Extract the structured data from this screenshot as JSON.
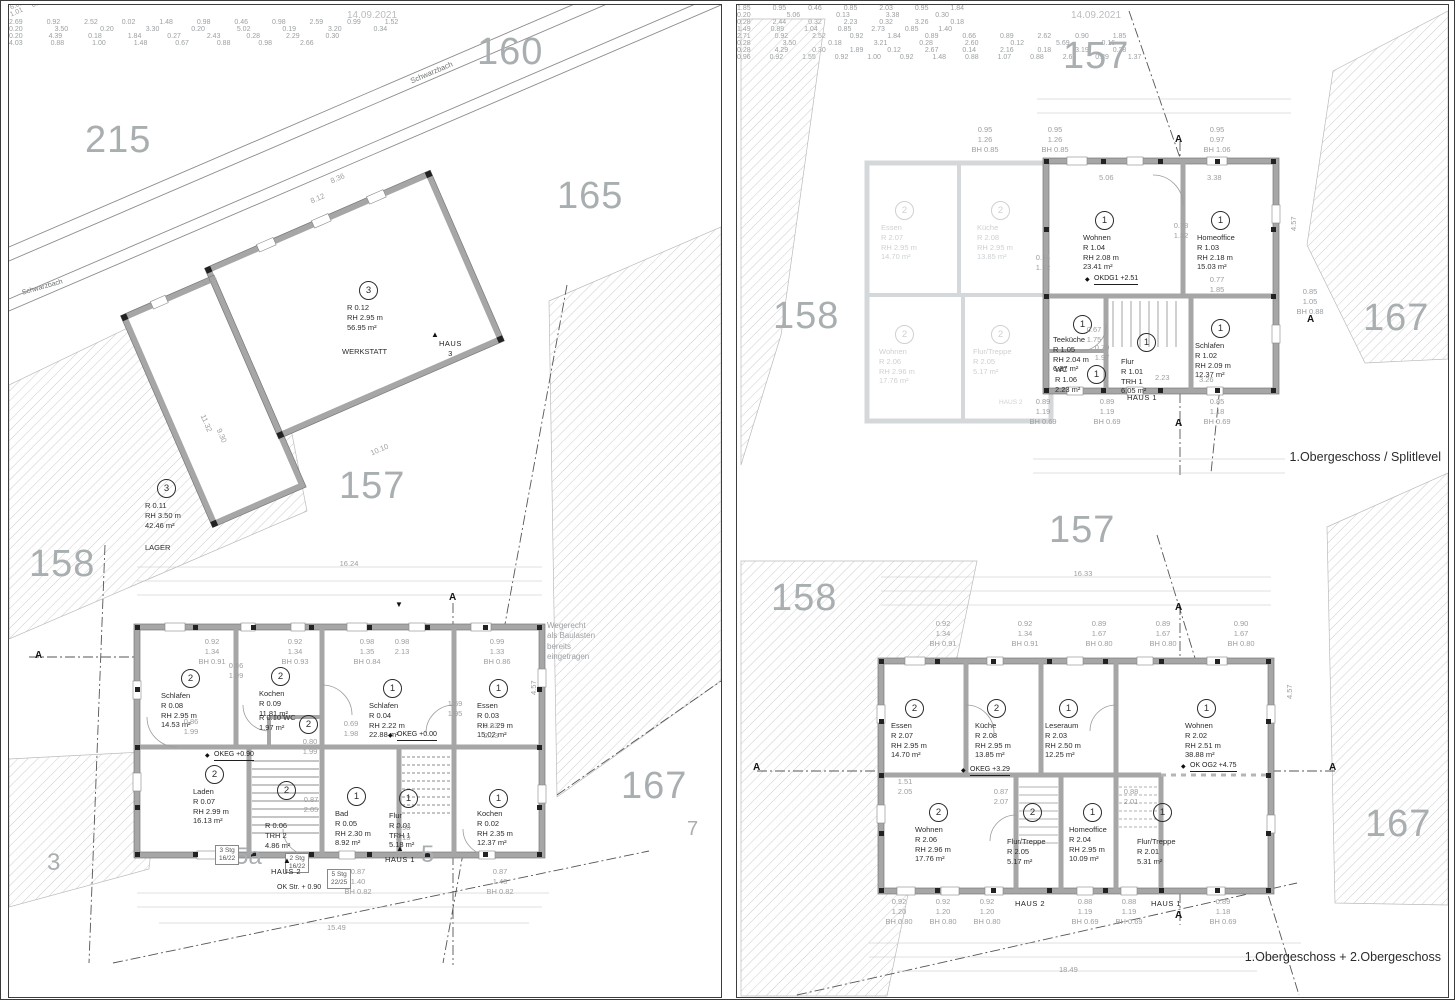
{
  "icons": {
    "level": "◆",
    "tri": "▲",
    "tri_down": "▼"
  },
  "left": {
    "date": "14.09.2021",
    "parcels": {
      "p160": "160",
      "p215": "215",
      "p165": "165",
      "p157": "157",
      "p158": "158",
      "p167": "167",
      "p3": "3",
      "p7": "7",
      "p5a": "5a",
      "p5": "5"
    },
    "streets": {
      "top": "Schwarzbach",
      "left": "Schwarzbach"
    },
    "note": "Wegerecht\nals Baulasten\nbereits\neingetragen",
    "haus_labels": {
      "h1": "HAUS 1",
      "h2": "HAUS 2",
      "h3": "HAUS\n3"
    },
    "levels": {
      "eg": "OKEG +0.00",
      "eg90": "OKEG +0.90",
      "street": "OK Str. + 0.90"
    },
    "stairs": {
      "s1": "3 Stg\n16/22",
      "s2": "2 Stg\n16/22",
      "s3": "5 Stg\n22/25"
    },
    "rooms": [
      {
        "unit": "3",
        "lines": "R 0.12\nRH 2.95 m\n56.95 m²",
        "name": "WERKSTATT"
      },
      {
        "unit": "3",
        "lines": "R 0.11\nRH 3.50 m\n42.46 m²",
        "name": "LAGER"
      },
      {
        "unit": "2",
        "lines": "Schlafen\nR 0.08\nRH 2.95 m\n14.53 m²"
      },
      {
        "unit": "2",
        "lines": "Kochen\nR 0.09\n11.81 m²"
      },
      {
        "unit": "2",
        "lines": "R 0.10 WC\n1.97 m²"
      },
      {
        "unit": "1",
        "lines": "Schlafen\nR 0.04\nRH 2.22 m\n22.88 m²"
      },
      {
        "unit": "1",
        "lines": "Essen\nR 0.03\nRH 2.29 m\n15.02 m²"
      },
      {
        "unit": "2",
        "lines": "Laden\nR 0.07\nRH 2.99 m\n16.13 m²"
      },
      {
        "unit": "2",
        "lines": "R 0.06\nTRH 2\n4.86 m²"
      },
      {
        "unit": "1",
        "lines": "Bad\nR 0.05\nRH 2.30 m\n8.92 m²"
      },
      {
        "unit": "1",
        "lines": "Flur\nR 0.01\nTRH 1\n5.18 m²"
      },
      {
        "unit": "1",
        "lines": "Kochen\nR 0.02\nRH 2.35 m\n12.37 m²"
      }
    ],
    "dims": {
      "total_top": "16.24",
      "row1": "2.69 0.92 2.52 0.02 1.48 0.98 0.46 0.98 2.59 0.99 1.52",
      "row2": "0.20 3.50 0.20 3.30 0.20 5.02 0.19 3.20 0.34",
      "brow1": "0.20 4.39 0.18 1.84 0.27 2.43 0.28 2.29 0.30",
      "brow2": "4.03 0.88 1.00 1.48 0.67 0.88 0.98 2.66",
      "total_bottom": "15.49",
      "road1": "8.36",
      "road2": "8.12",
      "road3": "6.01 0.80 0.89 0.80 1.73",
      "road4": "5.24",
      "se1": "1.01 0.74 1.01 0.74 1.01 0.74 1.01 0.74",
      "se2": "10.10",
      "v1": "11.32",
      "v2": "9.30",
      "v3": "4.57",
      "w1": "0.92\n1.34\nBH 0.91",
      "w2": "0.86\n1.99",
      "w3": "0.92\n1.34\nBH 0.93",
      "w4": "0.98\n1.35\nBH 0.84",
      "w5": "0.98\n2.13",
      "w6": "0.99\n1.33\nBH 0.86",
      "m1": "0.86\n1.99",
      "m2": "0.69\n1.98",
      "m3": "1.69\n1.95",
      "m4": "0.83\n2.03",
      "m5": "0.80\n1.99",
      "m6": "0.87\n2.05",
      "m7": "0.98\n2.13",
      "b1": "0.87\n1.40\nBH 0.82",
      "b2": "0.87\n1.40\nBH 0.82",
      "sec": "A"
    }
  },
  "right": {
    "date": "14.09.2021",
    "parcels": {
      "p157": "157",
      "p158a": "158",
      "p167a": "167",
      "p157b": "157",
      "p158b": "158",
      "p167b": "167"
    },
    "captions": {
      "top": "1.Obergeschoss / Splitlevel",
      "bottom": "1.Obergeschoss + 2.Obergeschoss"
    },
    "haus": {
      "h1": "HAUS 1",
      "h2": "HAUS 2",
      "h2b": "HAUS 2",
      "h1b": "HAUS 1"
    },
    "levels": {
      "dg1": "OKDG1 +2.51",
      "og1": "OKEG +3.29",
      "og2": "OK OG2 +4.75"
    },
    "top_rooms": [
      {
        "unit": "1",
        "lines": "Wohnen\nR 1.04\nRH 2.08 m\n23.41 m²"
      },
      {
        "unit": "1",
        "lines": "Homeoffice\nR 1.03\nRH 2.18 m\n15.03 m²"
      },
      {
        "unit": "1",
        "lines": "Teeküche\nR 1.05\nRH 2.04 m\n6.87 m²"
      },
      {
        "unit": "1",
        "lines": "Flur\nR 1.01\nTRH 1\n6.05 m²"
      },
      {
        "unit": "1",
        "lines": "WC\nR 1.06\n2.23 m²"
      },
      {
        "unit": "1",
        "lines": "Schlafen\nR 1.02\nRH 2.09 m\n12.37 m²"
      }
    ],
    "ghost_rooms": [
      {
        "unit": "2",
        "lines": "Essen\nR 2.07\nRH 2.95 m\n14.70 m²"
      },
      {
        "unit": "2",
        "lines": "Küche\nR 2.08\nRH 2.95 m\n13.85 m²"
      },
      {
        "unit": "2",
        "lines": "Wohnen\nR 2.06\nRH 2.96 m\n17.76 m²"
      },
      {
        "unit": "2",
        "lines": "Flur/Treppe\nR 2.05\n5.17 m²"
      }
    ],
    "bottom_rooms": [
      {
        "unit": "2",
        "lines": "Essen\nR 2.07\nRH 2.95 m\n14.70 m²"
      },
      {
        "unit": "2",
        "lines": "Küche\nR 2.08\nRH 2.95 m\n13.85 m²"
      },
      {
        "unit": "1",
        "lines": "Leseraum\nR 2.03\nRH 2.50 m\n12.25 m²"
      },
      {
        "unit": "1",
        "lines": "Wohnen\nR 2.02\nRH 2.51 m\n38.88 m²"
      },
      {
        "unit": "2",
        "lines": "Wohnen\nR 2.06\nRH 2.96 m\n17.76 m²"
      },
      {
        "unit": "2",
        "lines": "Flur/Treppe\nR 2.05\n5.17 m²"
      },
      {
        "unit": "1",
        "lines": "Homeoffice\nR 2.04\nRH 2.95 m\n10.09 m²"
      },
      {
        "unit": "1",
        "lines": "Flur/Treppe\nR 2.01\n5.31 m²"
      }
    ],
    "dims": {
      "trow1": "1.85 0.95 0.46 0.85 2.03 0.95 1.84",
      "trow2": "0.20 5.06 0.13 3.38 0.30",
      "tw1": "0.95\n1.26\nBH 0.85",
      "tw2": "0.95\n1.26\nBH 0.85",
      "tw3": "0.95\n0.97\nBH 1.06",
      "ti1": "5.06",
      "ti2": "3.38",
      "ti3": "0.74\n1.72",
      "ti4": "0.78\n1.82",
      "ti5": "0.77\n1.85",
      "ti6": "0.70\n1.97",
      "ti7": "0.67\n1.75",
      "ti8": "2.23",
      "ti9": "3.26",
      "ti10": "0.85\n1.05\nBH 0.88",
      "tb1": "0.89\n1.19\nBH 0.69",
      "tb2": "0.89\n1.19\nBH 0.69",
      "tb3": "0.85\n1.18\nBH 0.69",
      "tbrow1": "0.28 2.44 0.32 2.23 0.32 3.26 0.18",
      "tbrow2": "1.49 0.89 1.04 0.85 2.73 0.85 1.40",
      "btotal": "16.33",
      "brow1": "2.71 0.92 2.52 0.92 1.84 0.89 0.66 0.89 2.62 0.90 1.85",
      "brow2": "0.28 3.50 0.18 3.21 0.28 2.60 0.12 5.69 0.16",
      "bw1": "0.92\n1.34\nBH 0.91",
      "bw2": "0.92\n1.34\nBH 0.91",
      "bw3": "0.89\n1.67\nBH 0.80",
      "bw4": "0.89\n1.67\nBH 0.80",
      "bw5": "0.90\n1.67\nBH 0.80",
      "bi1": "1.51\n2.05",
      "bi2": "0.87\n2.07",
      "bi3": "0.88\n2.01",
      "bb1": "0.92\n1.20\nBH 0.80",
      "bb2": "0.92\n1.20\nBH 0.80",
      "bb3": "0.92\n1.20\nBH 0.80",
      "bb4": "0.88\n1.19\nBH 0.69",
      "bb5": "0.88\n1.19\nBH 0.69",
      "bb6": "0.89\n1.18\nBH 0.69",
      "bbrow1": "0.28 4.29 0.30 1.89 0.12 2.67 0.14 2.16 0.18 3.19 0.28",
      "bbrow2": "0.96 0.92 1.55 0.92 1.00 0.92 1.48 0.88 1.07 0.88 2.65 0.89 1.37",
      "bbtotal": "18.49",
      "v1": "4.57",
      "v2": "4.57",
      "sec": "A"
    }
  }
}
